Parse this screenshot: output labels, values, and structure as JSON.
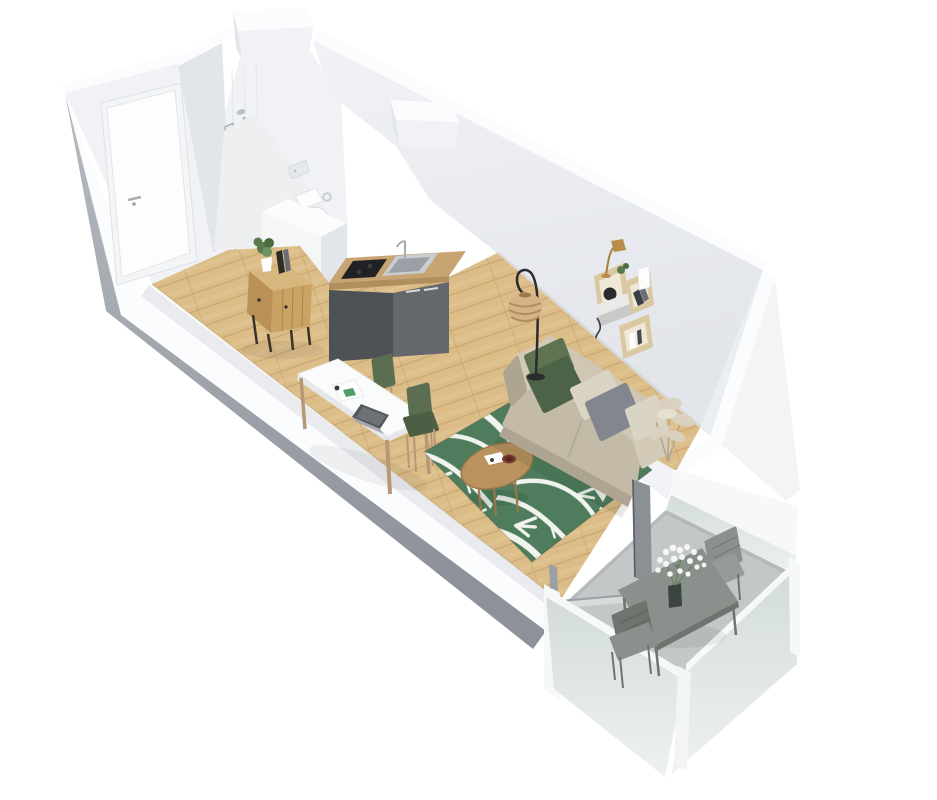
{
  "scene": {
    "kind": "3d-isometric-floor-plan-render",
    "subject": "studio-apartment-with-balcony",
    "rooms": [
      "entry",
      "bathroom",
      "kitchenette",
      "living-area",
      "balcony"
    ],
    "items": [
      "entrance-door",
      "shower",
      "shower-glass-screen",
      "toilet",
      "flush-plate",
      "toilet-paper-holder",
      "kitchen-cabinet",
      "cooktop",
      "kitchen-sink",
      "kitchen-faucet",
      "wood-sideboard",
      "potted-plant",
      "books",
      "dining-table",
      "laptop",
      "papers",
      "green-chair-1",
      "green-chair-2",
      "palm-leaf-rug",
      "round-coffee-table",
      "tray-items",
      "sofa",
      "green-cushions",
      "gray-cushion",
      "beige-cushions",
      "pampas-grass",
      "rattan-floor-lamp",
      "wall-cable",
      "box-wall-shelves",
      "desk-lamp",
      "black-vase",
      "white-cup",
      "balcony-table",
      "balcony-chair-1",
      "balcony-chair-2",
      "flower-vase",
      "frosted-glass-railing",
      "sliding-door-frame"
    ]
  },
  "colors": {
    "wall": "#f1f2f5",
    "wall-shade": "#e2e5ea",
    "wall-deep": "#dcdfe5",
    "wall-top": "#fbfcfd",
    "inner-strip": "#e9ebef",
    "outer-gray-light": "#b6bac1",
    "outer-gray-dark": "#8d929a",
    "floor-wood": "#dcbd88",
    "floor-line": "#c3a26e",
    "bath-floor": "#edeff1",
    "tile": "#f0f2f5",
    "white": "#fdfdfe",
    "chrome": "#a8aeb4",
    "counter-wood": "#c7a472",
    "cabinet-side": "#4e5155",
    "cabinet-front": "#64676b",
    "cooktop": "#1f2124",
    "steel": "#c9cdd1",
    "steel-dark": "#9aa0a5",
    "sideboard-top": "#d8b77f",
    "sideboard-front": "#c9a264",
    "sideboard-side": "#b99156",
    "table-white": "#fafbfb",
    "table-edge": "#e6e7e8",
    "wood-leg": "#b59876",
    "chair-green": "#5c6e51",
    "chair-green-dark": "#4d5e44",
    "rug-green": "#4e7c5c",
    "rug-leaf": "#f1f4ee",
    "coffee-wood": "#b9925e",
    "coffee-wood-dark": "#9c7848",
    "sofa": "#cfc7b4",
    "sofa-seat": "#c3bba8",
    "sofa-arm": "#d3cbb8",
    "sofa-base": "#ada591",
    "pillow-green": "#5f7351",
    "pillow-green-dark": "#4d6347",
    "pillow-gray": "#83868e",
    "pillow-beige": "#dad4c4",
    "lamp-rattan": "#d6b384",
    "lamp-rattan-stripe": "#b08d5e",
    "black": "#2b2b2e",
    "shelf-wood": "#d9c8a0",
    "shelf-inner": "#efe8d6",
    "shelf-shade": "#bba878",
    "brass": "#b98c4a",
    "pampas": "#dbd2c2",
    "pampas-stem": "#b5a58e",
    "balcony-floor": "#c3c7c8",
    "balcony-furniture": "#8a918c",
    "balcony-furniture-dark": "#6e756f",
    "balcony-furniture-light": "#959c97",
    "rail-frame": "#f7f9f9",
    "frost-top": "#d3dcd9",
    "frost-bottom": "#eef2f0",
    "door-bar": "#8b9095",
    "plant-green": "#5b7a4e",
    "flower-white": "#f6f7f4"
  }
}
